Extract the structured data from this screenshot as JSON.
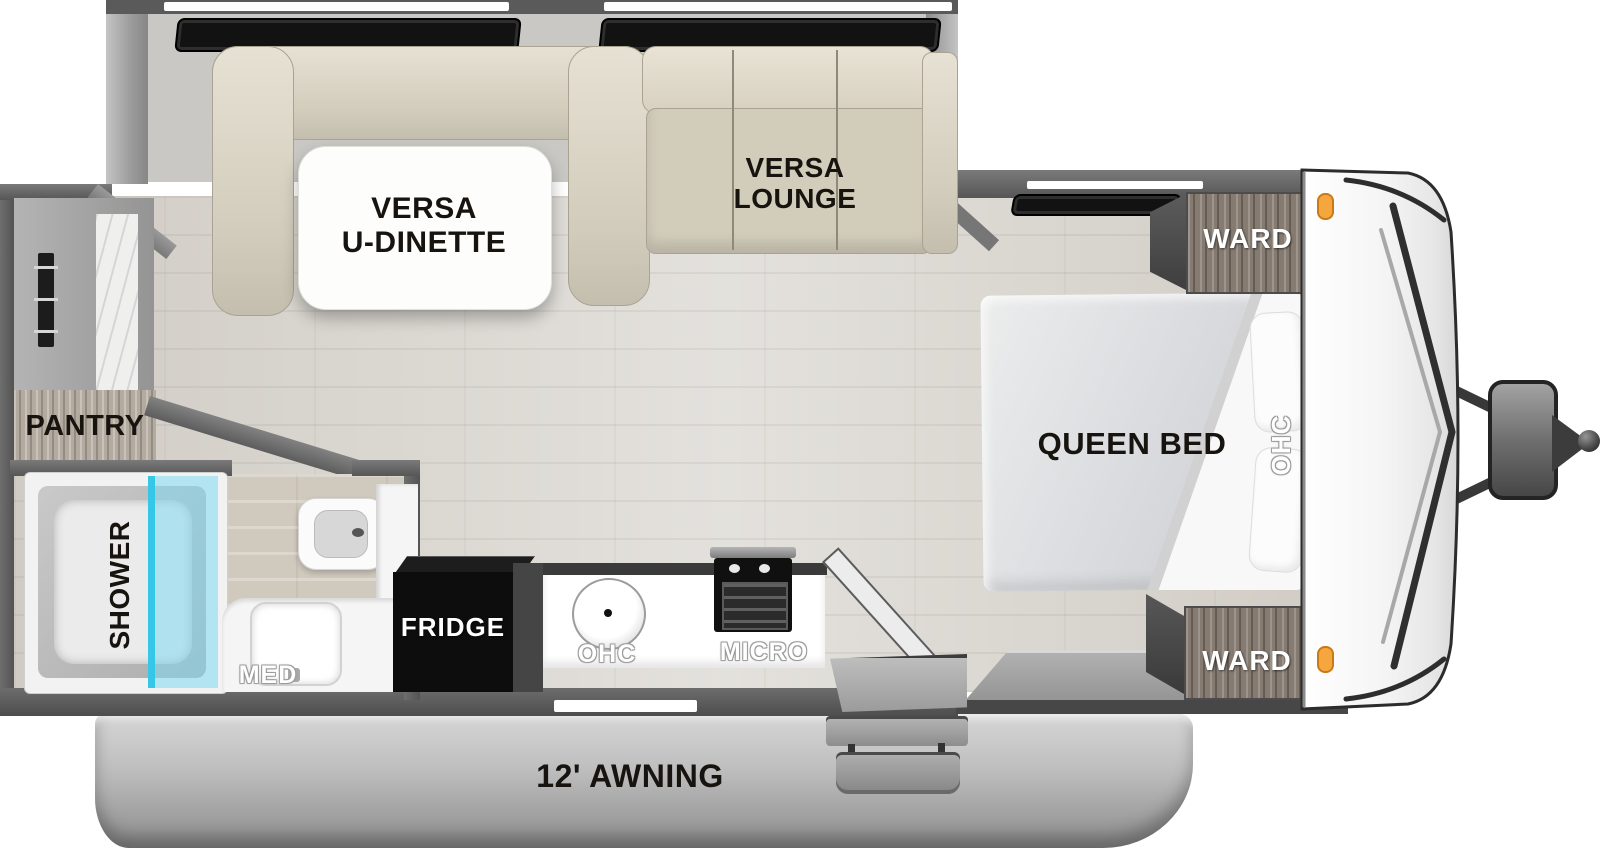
{
  "floorplan": {
    "type": "travel-trailer-floorplan-top-view",
    "labels": {
      "dinette_l1": "VERSA",
      "dinette_l2": "U-DINETTE",
      "lounge_l1": "VERSA",
      "lounge_l2": "LOUNGE",
      "queen_bed": "QUEEN BED",
      "ward_rear": "WARD",
      "ward_front": "WARD",
      "ohc_bedroom": "OHC",
      "ohc_kitchen": "OHC",
      "micro": "MICRO",
      "fridge": "FRIDGE",
      "med": "MED",
      "pantry": "PANTRY",
      "shower": "SHOWER",
      "awning": "12' AWNING"
    },
    "colors": {
      "wall": "#5E5E5E",
      "floor": "#DAD7D1",
      "bench": "#D8D2C2",
      "wood_cabinet": "#857B71",
      "wood_pantry": "#B4ABA0",
      "marker_light": "#F6A63E",
      "shower_glass": "#7FD8F0",
      "awning_band": "#B5B5B5",
      "fridge": "#0D0D0D"
    }
  }
}
